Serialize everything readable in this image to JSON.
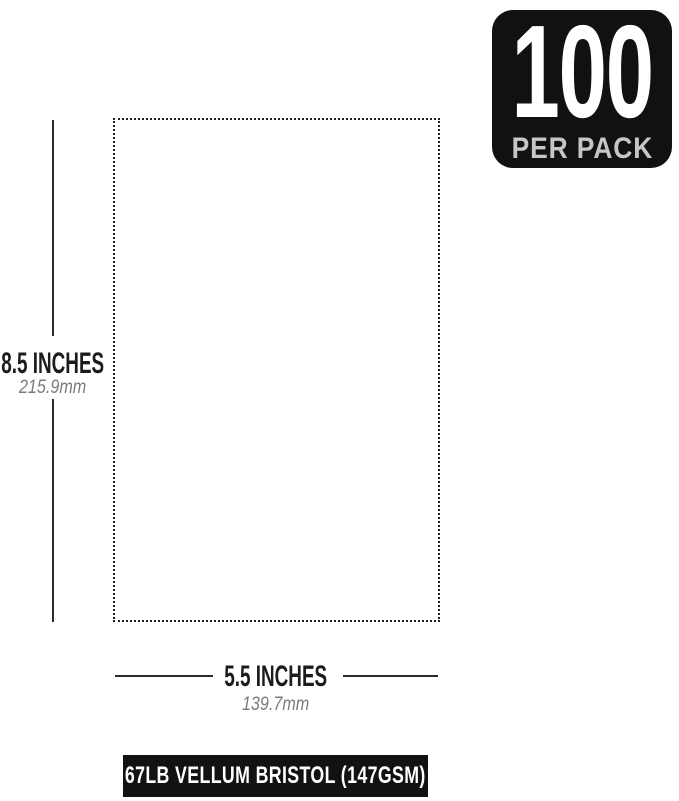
{
  "badge": {
    "count": "100",
    "label": "PER PACK"
  },
  "dimensions": {
    "height": {
      "imperial": "8.5 INCHES",
      "metric": "215.9mm"
    },
    "width": {
      "imperial": "5.5 INCHES",
      "metric": "139.7mm"
    }
  },
  "footer": {
    "label": "67LB VELLUM BRISTOL (147GSM)"
  },
  "colors": {
    "ink": "#2b2b2b",
    "badge_bg": "#111111",
    "badge_count": "#ffffff",
    "badge_label": "#c6c6c6",
    "imperial_text": "#1c1c1c",
    "metric_text": "#7b7b7b",
    "footer_bg": "#121212",
    "footer_text": "#ffffff"
  }
}
